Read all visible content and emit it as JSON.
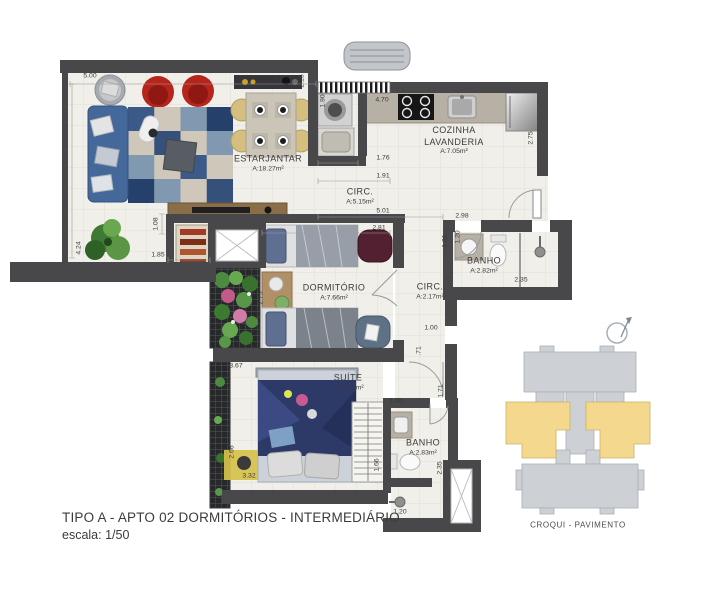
{
  "meta": {
    "title_line1": "TIPO A - APTO 02  DORMITÓRIOS - INTERMEDIÁRIO",
    "title_line2": "escala: 1/50"
  },
  "croqui": {
    "label": "CROQUI - PAVIMENTO",
    "highlight_color": "#f3d88e",
    "building_color": "#cdd1d6"
  },
  "rooms": {
    "estar": {
      "name": "ESTARJANTAR",
      "area": "A:18.27m²"
    },
    "cozinha": {
      "name": "COZINHA",
      "name2": "LAVANDERIA",
      "area": "A:7.05m²"
    },
    "circ1": {
      "name": "CIRC.",
      "area": "A:5.15m²"
    },
    "banho1": {
      "name": "BANHO",
      "area": "A:2.82m²"
    },
    "dorm": {
      "name": "DORMITÓRIO",
      "area": "A:7.66m²"
    },
    "circ2": {
      "name": "CIRC.",
      "area": "A:2.17m²"
    },
    "suite": {
      "name": "SUÍTE",
      "area": "A:10.63m²"
    },
    "banho2": {
      "name": "BANHO",
      "area": "A:2.83m²"
    }
  },
  "dims": {
    "living_width": "5.00",
    "living_height": "4.24",
    "laundry_height": "2.15",
    "laundry_inner": "1.90",
    "kitchen_width": "4.70",
    "hall_w1": "1.76",
    "hall_w2": "1.91",
    "hall_w3": "5.01",
    "dorm_width": "2.81",
    "banho1_width": "2.98",
    "banho1_height": "1.91",
    "banho1_counter": "1.20",
    "kitchen_depth": "2.75",
    "banho1_length": "2.35",
    "shelf_height": "1.08",
    "shelf_width": "1.85",
    "dorm_depth": "2.73",
    "circ2_w": "1.00",
    "circ2_seg": ".71",
    "circ2_h": "1.71",
    "closet_w": "1.35",
    "suite_width": "3.67",
    "suite_depth": "2.66",
    "suite_bottom": "3.32",
    "closet_h": "1.66",
    "banho2_len": "2.35",
    "banho2_w": "1.20"
  },
  "colors": {
    "wall": "#48484b",
    "floor": "#f0efe9",
    "sofa_blue": "#45689b",
    "chair_red": "#b5251c",
    "suite_duvet": "#2d3a68",
    "rug_yellow": "#d6c14b"
  }
}
